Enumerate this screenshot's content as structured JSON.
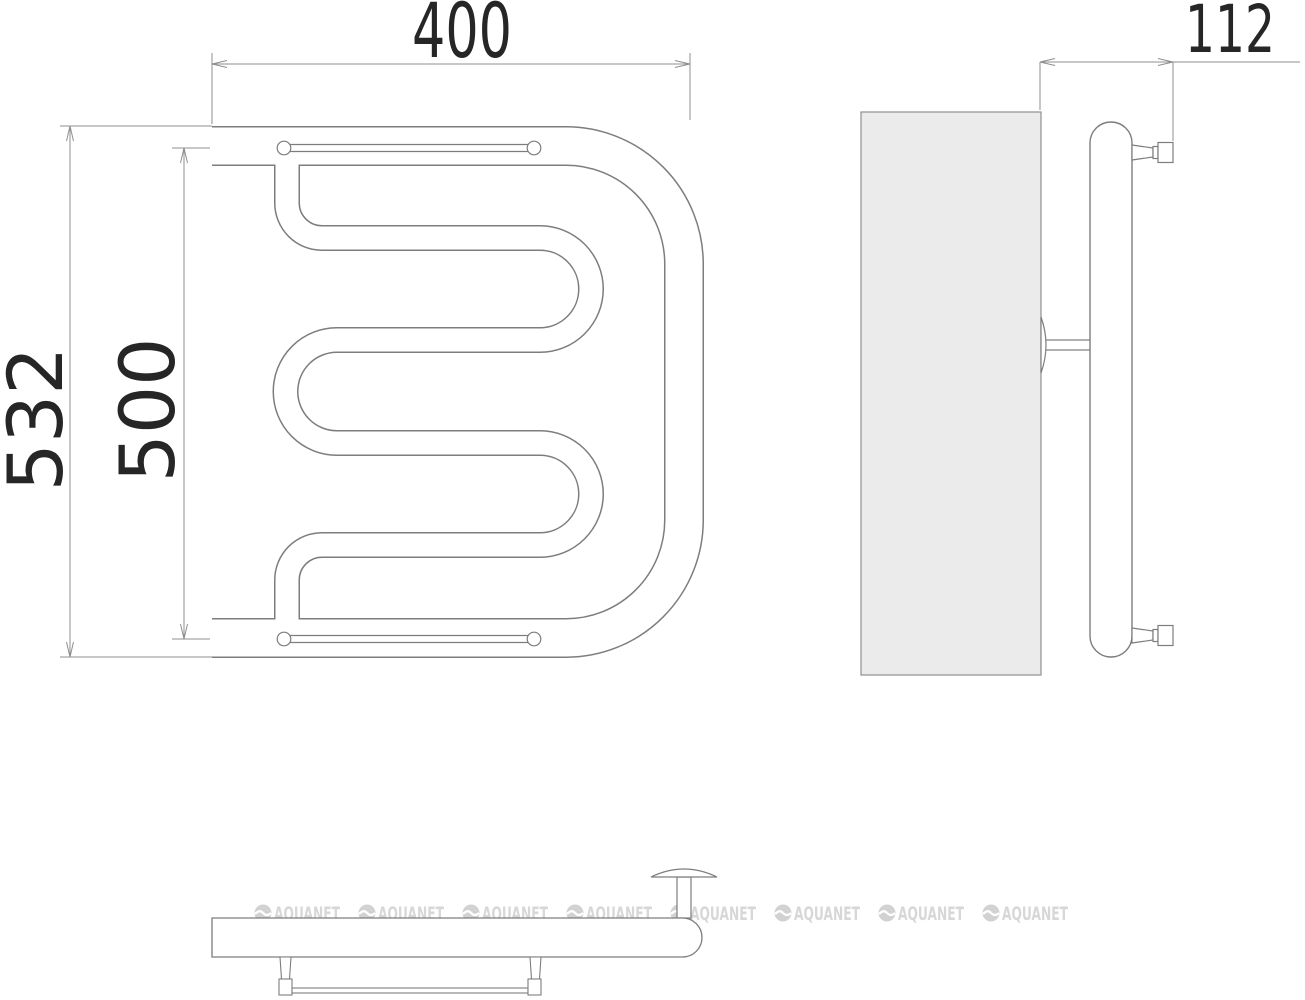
{
  "drawing": {
    "dimensions": {
      "front_width": {
        "value": "400",
        "unit_note": "top horizontal dimension"
      },
      "side_depth": {
        "value": "112",
        "unit_note": "top right horizontal dimension"
      },
      "overall_height": {
        "value": "532",
        "unit_note": "left outer vertical dimension"
      },
      "axis_height": {
        "value": "500",
        "unit_note": "left inner vertical dimension"
      }
    },
    "watermark": {
      "text": "AQUANET",
      "count": 8,
      "color": "#d7d7d7"
    },
    "colors": {
      "background": "#ffffff",
      "line": "#7d7d7d",
      "dimension_line": "#8f8f8f",
      "text": "#262626",
      "wall_fill": "#ebebeb"
    }
  }
}
